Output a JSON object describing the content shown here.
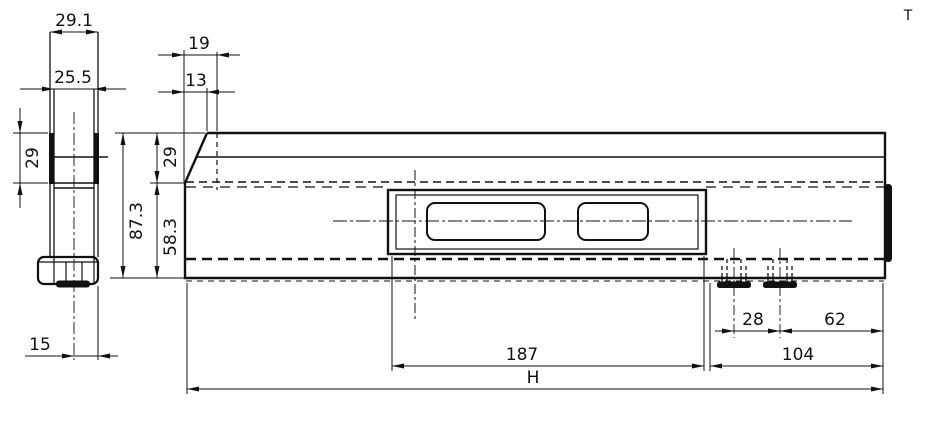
{
  "drawing": {
    "corner_mark": "T",
    "line_color": "#111111",
    "end_view": {
      "dimensions": {
        "outer_width": "29.1",
        "inner_width": "25.5",
        "upper_height": "29",
        "center_to_edge": "15"
      }
    },
    "side_view": {
      "dimensions": {
        "top_inset": "19",
        "chamfer_inset": "13",
        "upper_height": "29",
        "total_height": "87.3",
        "lower_height": "58.3",
        "opening_length": "187",
        "overall_length": "H",
        "foot_pitch": "28",
        "foot_to_end": "62",
        "foot_zone_length": "104"
      }
    }
  }
}
